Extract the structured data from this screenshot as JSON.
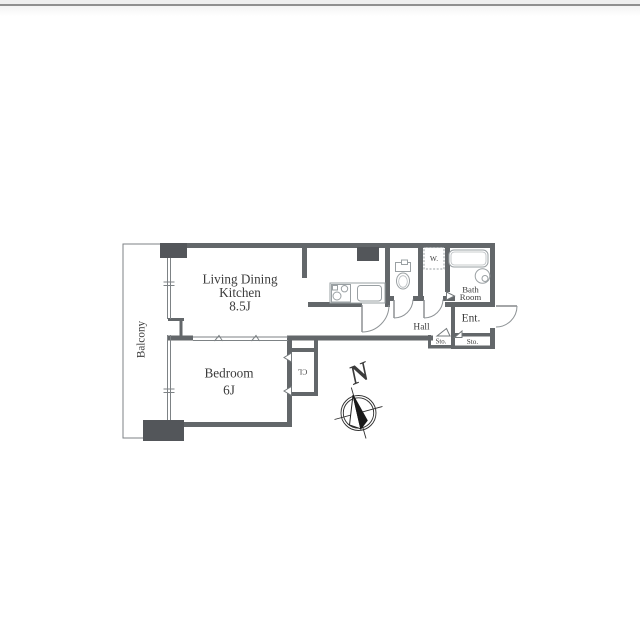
{
  "floor_plan": {
    "rooms": {
      "living_dining_kitchen": {
        "label_line1": "Living Dining",
        "label_line2": "Kitchen",
        "size_label": "8.5J"
      },
      "bedroom": {
        "label": "Bedroom",
        "size_label": "6J"
      },
      "balcony": {
        "label": "Balcony"
      },
      "bath_room": {
        "label_line1": "Bath",
        "label_line2": "Room"
      },
      "hall": {
        "label": "Hall"
      },
      "entrance": {
        "label": "Ent."
      },
      "storage_left": {
        "label": "Sto."
      },
      "storage_right": {
        "label": "Sto."
      },
      "washer_space": {
        "label": "W."
      },
      "closet": {
        "label": "CL"
      }
    },
    "compass": {
      "label": "N"
    },
    "colors": {
      "wall": "#63676a",
      "pillar": "#53565a",
      "fixture_stroke": "#9aa0a3",
      "text": "#3b3b3b",
      "top_bar": "#eeeeee",
      "top_bar_line": "#8f8f8f"
    }
  }
}
